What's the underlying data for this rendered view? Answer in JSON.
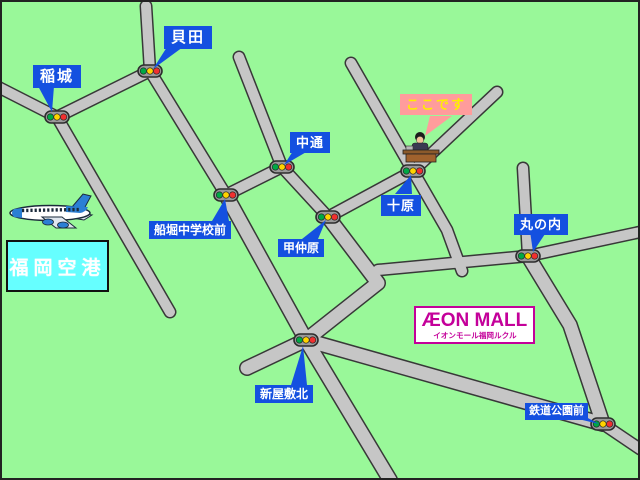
{
  "map_title": "AEON MALL access map",
  "labels": {
    "inagi": "稲城",
    "kaida": "貝田",
    "nakadori": "中通",
    "funabori_chugakko_mae": "船堀中学校前",
    "konakahara": "甲仲原",
    "juhara": "十原",
    "marunouchi": "丸の内",
    "shinyashiki_kita": "新屋敷北",
    "tetsudo_koen_mae": "鉄道公園前",
    "koko_desu": "ここです"
  },
  "airport": {
    "name": "福岡空港"
  },
  "mall": {
    "title": "ÆON MALL",
    "subtitle": "イオンモール福岡ルクル"
  },
  "icons": {
    "traffic_signal": "traffic-light-icon",
    "airplane": "airplane-icon",
    "desk_person": "reception-desk-icon"
  },
  "colors": {
    "background": "#99f899",
    "road_fill": "#c6c6c6",
    "road_outline": "#383838",
    "callout_blue": "#1450e0",
    "callout_text": "#ffffff",
    "here_bg": "#ff9c9c",
    "here_text": "#ffee00",
    "airport_bg": "#66ffff",
    "airport_text": "#ffffff",
    "aeon_magenta": "#c4009a",
    "signal_green": "#00a845",
    "signal_yellow": "#ffd300",
    "signal_red": "#f03030"
  }
}
